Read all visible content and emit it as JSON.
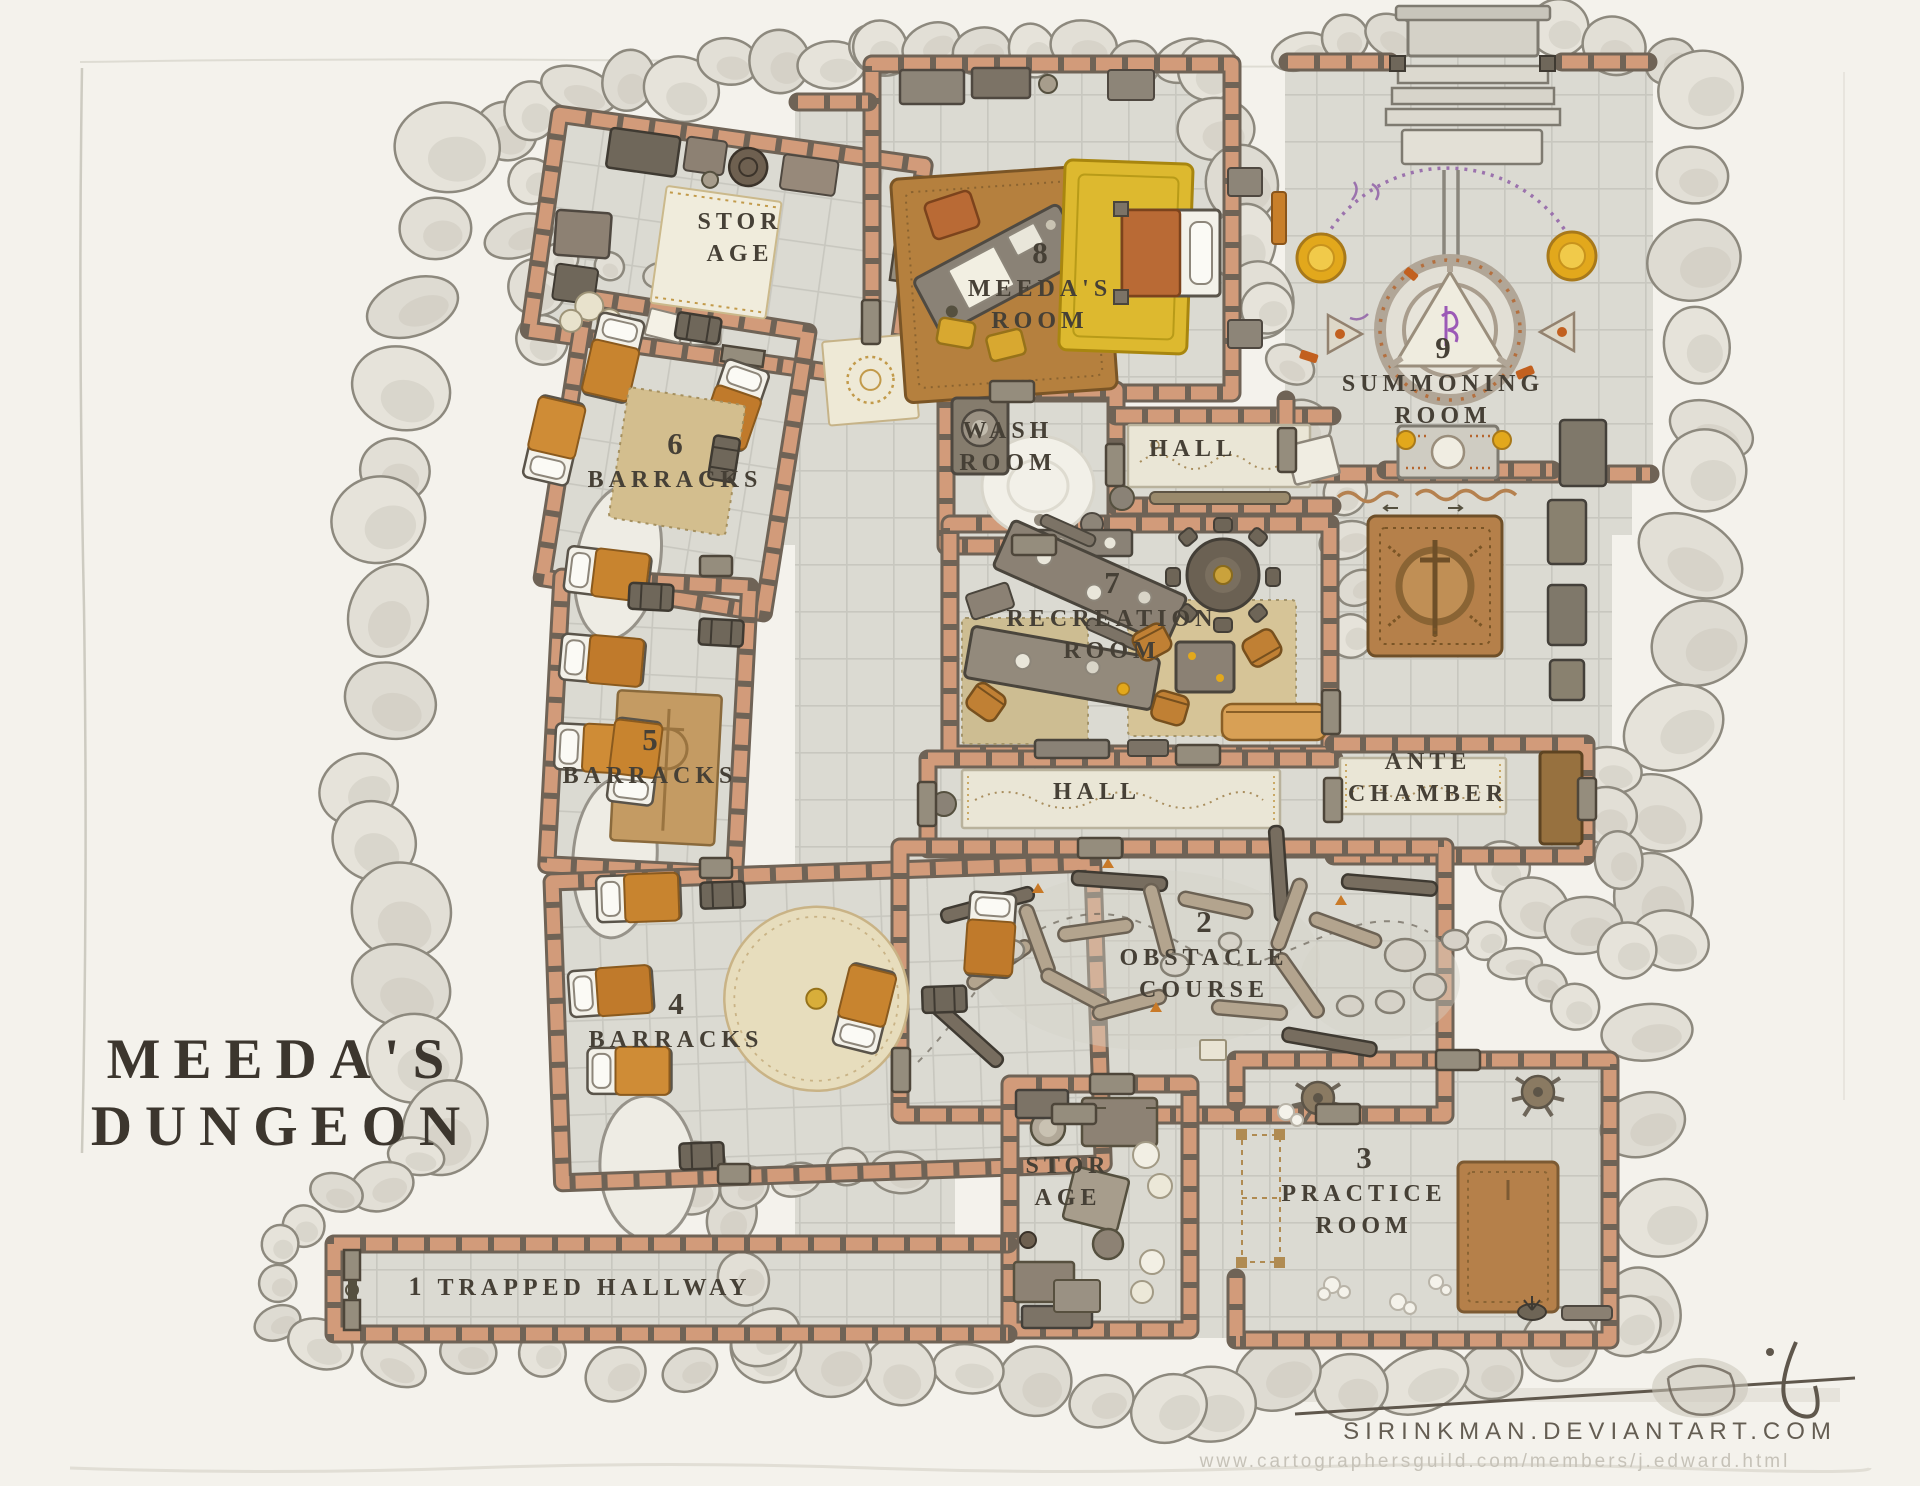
{
  "title": "MEEDA'S\nDUNGEON",
  "rooms": [
    {
      "number": "1",
      "name": "TRAPPED HALLWAY"
    },
    {
      "number": "2",
      "name": "OBSTACLE\nCOURSE"
    },
    {
      "number": "3",
      "name": "PRACTICE\nROOM"
    },
    {
      "number": "4",
      "name": "BARRACKS"
    },
    {
      "number": "5",
      "name": "BARRACKS"
    },
    {
      "number": "6",
      "name": "BARRACKS"
    },
    {
      "number": "7",
      "name": "RECREATION\nROOM"
    },
    {
      "number": "8",
      "name": "MEEDA'S\nROOM"
    },
    {
      "number": "9",
      "name": "SUMMONING\nROOM"
    }
  ],
  "areas": [
    {
      "name": "STOR\nAGE"
    },
    {
      "name": "WASH\nROOM"
    },
    {
      "name": "HALL"
    },
    {
      "name": "HALL"
    },
    {
      "name": "ANTE\nCHAMBER"
    },
    {
      "name": "STOR\nAGE"
    }
  ],
  "footer": {
    "site": "SIRINKMAN.DEVIANTART.COM",
    "url": "www.cartographersguild.com/members/j.edward.html"
  },
  "colors": {
    "page": "#f4f2ec",
    "floor_tile": "#dbdad2",
    "grid_line": "#c8c7bf",
    "wall_brick": "#d29b7a",
    "wall_shadow": "#6f6356",
    "rock": "#e3e0d7",
    "rug_tan": "#d3be8e",
    "rug_brown": "#b5804a",
    "rug_yellow": "#ddb92f",
    "rug_cream": "#eee9d6",
    "blanket_orange": "#c8842f",
    "gold": "#e2a81c",
    "rune_purple": "#9b72ad",
    "ink": "#464036"
  }
}
